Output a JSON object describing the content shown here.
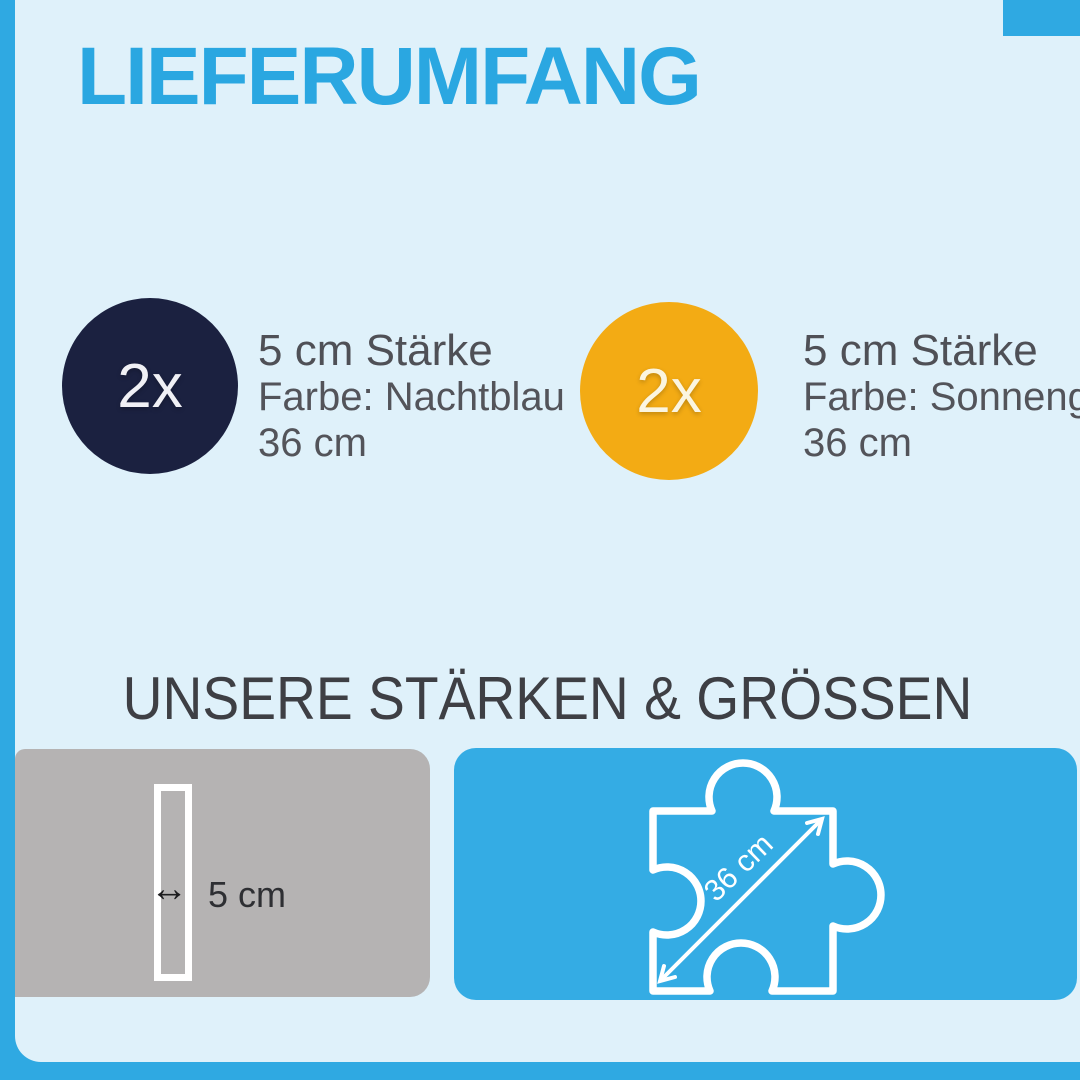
{
  "page": {
    "title": "LIEFERUMFANG",
    "section_heading": "UNSERE STÄRKEN & GRÖSSEN"
  },
  "items": [
    {
      "badge": "2x",
      "circle_color": "#1B2140",
      "line1": "5 cm Stärke",
      "line2": "Farbe: Nachtblau",
      "line3": "36 cm"
    },
    {
      "badge": "2x",
      "circle_color": "#F3AB14",
      "line1": "5 cm Stärke",
      "line2": "Farbe: Sonnengelb",
      "line3": "36 cm"
    }
  ],
  "thickness_panel": {
    "arrow_icon": "↔",
    "label": "5 cm"
  },
  "size_panel": {
    "diagonal_label": "36 cm"
  },
  "colors": {
    "frame_blue": "#2FA9E2",
    "background_light": "#DFF1FA",
    "title_blue": "#2AA7E1",
    "panel_blue": "#34ACE4",
    "panel_gray": "#B5B3B3",
    "navy": "#1B2140",
    "yellow": "#F3AB14",
    "text_gray": "#53545A",
    "heading_gray": "#3E3F44"
  }
}
